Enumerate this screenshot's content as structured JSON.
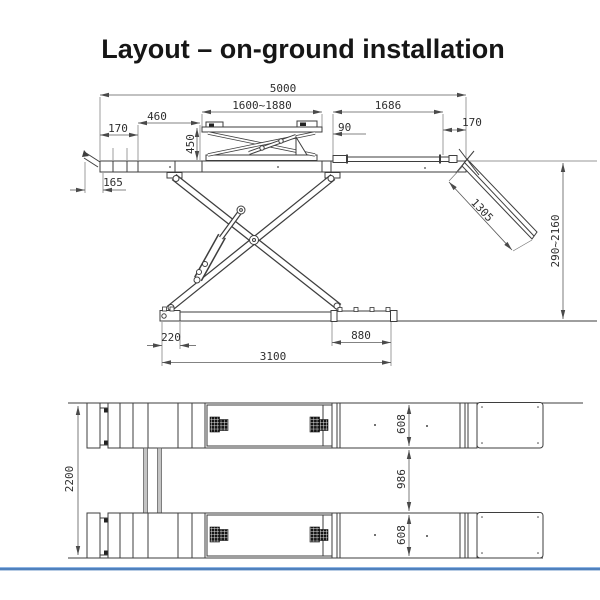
{
  "title": "Layout – on-ground installation",
  "colors": {
    "accent_blue": "#4f81bd",
    "accent_blue_light": "#8eb4e3",
    "line": "#3e3e3e"
  },
  "side_view": {
    "dims": {
      "overall_length": "5000",
      "jack_platform_range": "1600~1880",
      "approach_length": "1686",
      "left_edge_170": "170",
      "left_460": "460",
      "jack_height": "450",
      "gap_90": "90",
      "right_edge_170": "170",
      "wedge_165": "165",
      "ramp_length": "1305",
      "lift_height_range": "290~2160",
      "base_220": "220",
      "base_880": "880",
      "base_length": "3100"
    }
  },
  "plan_view": {
    "dims": {
      "overall_width": "2200",
      "platform_width_top": "608",
      "track_gap": "986",
      "platform_width_bottom": "608"
    }
  }
}
